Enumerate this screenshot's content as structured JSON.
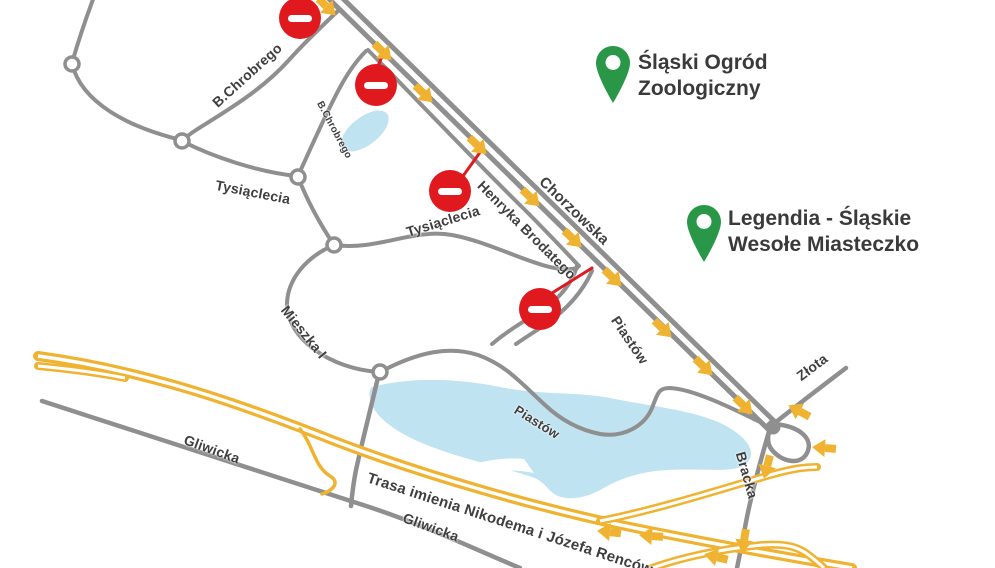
{
  "map": {
    "colors": {
      "road": "#8f8f8f",
      "highway": "#f0b331",
      "closure": "#e0191f",
      "poi_pin": "#2a9748",
      "water": "#bfe3f1",
      "label": "#3f3f3f"
    },
    "pois": [
      {
        "name": "Śląski Ogród Zoologiczny",
        "line1": "Śląski Ogród",
        "line2": "Zoologiczny"
      },
      {
        "name": "Legendia - Śląskie Wesołe Miasteczko",
        "line1": "Legendia - Śląskie",
        "line2": "Wesołe Miasteczko"
      }
    ],
    "street_labels": [
      {
        "text": "B.Chrobrego",
        "x": 247,
        "y": 75,
        "rot": -42,
        "size": 14
      },
      {
        "text": "B.Chrobrego",
        "x": 334,
        "y": 130,
        "rot": 62,
        "size": 10
      },
      {
        "text": "Tysiąclecia",
        "x": 253,
        "y": 192,
        "rot": 11,
        "size": 14
      },
      {
        "text": "Tysiąclecia",
        "x": 443,
        "y": 221,
        "rot": -17,
        "size": 14
      },
      {
        "text": "Henryka Brodatego",
        "x": 527,
        "y": 230,
        "rot": 45,
        "size": 14
      },
      {
        "text": "Chorzowska",
        "x": 574,
        "y": 211,
        "rot": 44,
        "size": 15
      },
      {
        "text": "Piastów",
        "x": 630,
        "y": 340,
        "rot": 56,
        "size": 14
      },
      {
        "text": "Piastów",
        "x": 537,
        "y": 422,
        "rot": 32,
        "size": 13
      },
      {
        "text": "Mieszka I",
        "x": 304,
        "y": 332,
        "rot": 51,
        "size": 14
      },
      {
        "text": "Gliwicka",
        "x": 212,
        "y": 449,
        "rot": 20,
        "size": 14
      },
      {
        "text": "Gliwicka",
        "x": 431,
        "y": 527,
        "rot": 20,
        "size": 14
      },
      {
        "text": "Trasa imienia Nikodema i Józefa Renców",
        "x": 510,
        "y": 524,
        "rot": 18,
        "size": 15
      },
      {
        "text": "Złota",
        "x": 812,
        "y": 367,
        "rot": -37,
        "size": 14
      },
      {
        "text": "Bracka",
        "x": 747,
        "y": 475,
        "rot": 74,
        "size": 14
      }
    ],
    "no_entry_signs": [
      {
        "x": 300,
        "y": 18
      },
      {
        "x": 376,
        "y": 85
      },
      {
        "x": 450,
        "y": 191
      },
      {
        "x": 540,
        "y": 309
      }
    ],
    "direction_arrows": [
      {
        "x": 327,
        "y": 7,
        "angle": 44
      },
      {
        "x": 383,
        "y": 52,
        "angle": 44
      },
      {
        "x": 424,
        "y": 94,
        "angle": 44
      },
      {
        "x": 478,
        "y": 146,
        "angle": 44
      },
      {
        "x": 531,
        "y": 198,
        "angle": 44
      },
      {
        "x": 573,
        "y": 239,
        "angle": 44
      },
      {
        "x": 613,
        "y": 278,
        "angle": 44
      },
      {
        "x": 663,
        "y": 329,
        "angle": 44
      },
      {
        "x": 704,
        "y": 367,
        "angle": 44
      },
      {
        "x": 744,
        "y": 406,
        "angle": 44
      },
      {
        "x": 799,
        "y": 411,
        "angle": 208
      },
      {
        "x": 824,
        "y": 448,
        "angle": 184
      },
      {
        "x": 767,
        "y": 467,
        "angle": 104
      },
      {
        "x": 744,
        "y": 541,
        "angle": 99
      },
      {
        "x": 716,
        "y": 557,
        "angle": 193
      },
      {
        "x": 609,
        "y": 532,
        "angle": 186
      },
      {
        "x": 651,
        "y": 536,
        "angle": 184
      }
    ]
  }
}
